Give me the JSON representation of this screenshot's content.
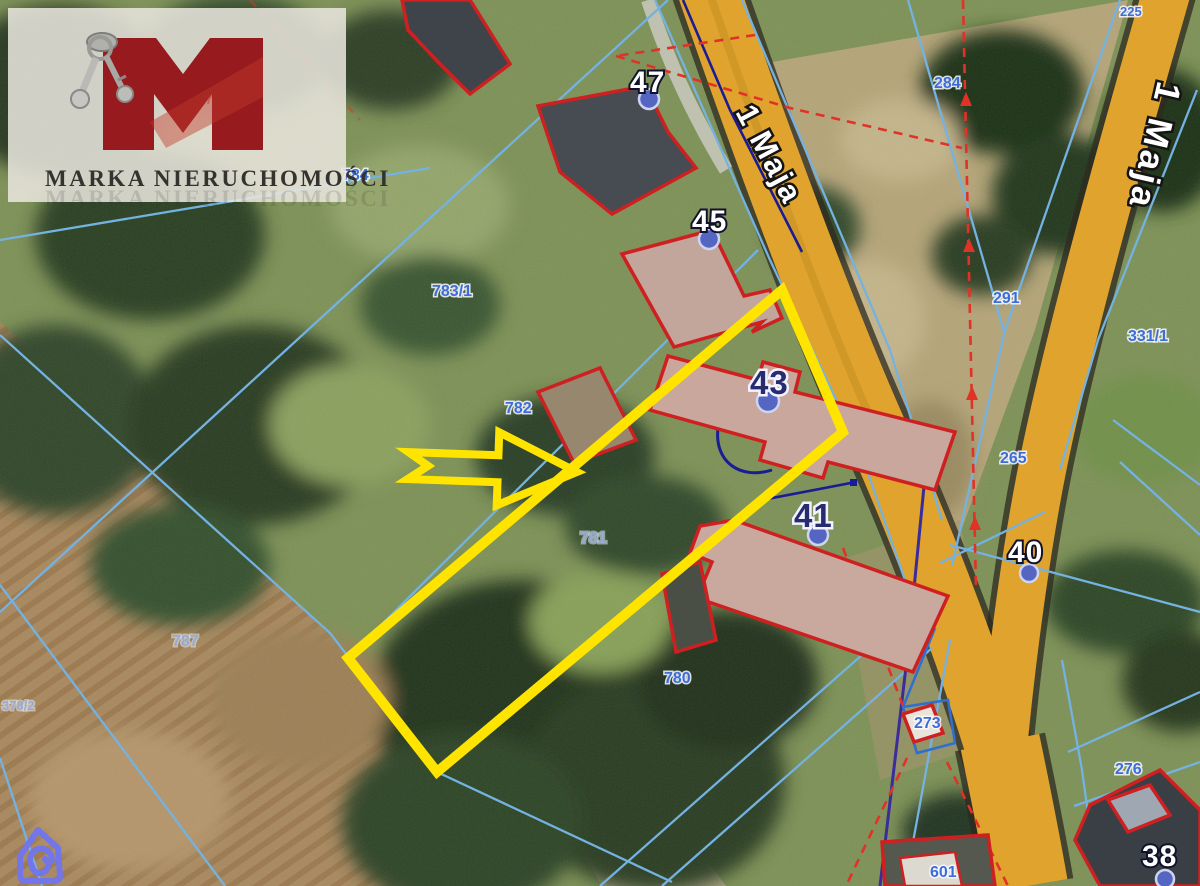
{
  "brand": {
    "company_name": "MARKA NIERUCHOMOŚCI",
    "logo_letter": "M",
    "logo_color": "#971b1e"
  },
  "watermark": {
    "icon": "house-spiral",
    "color": "#7276e8"
  },
  "map": {
    "street_labels": [
      {
        "text": "1 Maja"
      },
      {
        "text": "1 Maja"
      }
    ],
    "address_markers": [
      {
        "number": "47"
      },
      {
        "number": "45"
      },
      {
        "number": "43"
      },
      {
        "number": "41"
      },
      {
        "number": "40"
      },
      {
        "number": "38"
      }
    ],
    "parcel_labels": [
      {
        "id": "788"
      },
      {
        "id": "784"
      },
      {
        "id": "783/1"
      },
      {
        "id": "782"
      },
      {
        "id": "781"
      },
      {
        "id": "787"
      },
      {
        "id": "780"
      },
      {
        "id": "378/2"
      },
      {
        "id": "284"
      },
      {
        "id": "225"
      },
      {
        "id": "291"
      },
      {
        "id": "331/1"
      },
      {
        "id": "265"
      },
      {
        "id": "273"
      },
      {
        "id": "276"
      },
      {
        "id": "601"
      }
    ],
    "highlight": {
      "description": "offered parcel outline with pointer arrow",
      "color": "#ffe400"
    },
    "colors": {
      "road": "#e0a32d",
      "cadastral_line": "#74b2e2",
      "building_outline": "#ce2020",
      "boundary_dashed": "#e03226",
      "utility_line": "#1a1c96",
      "marker_dot": "#5565c2",
      "parcel_label": "#3d6ed8"
    }
  }
}
